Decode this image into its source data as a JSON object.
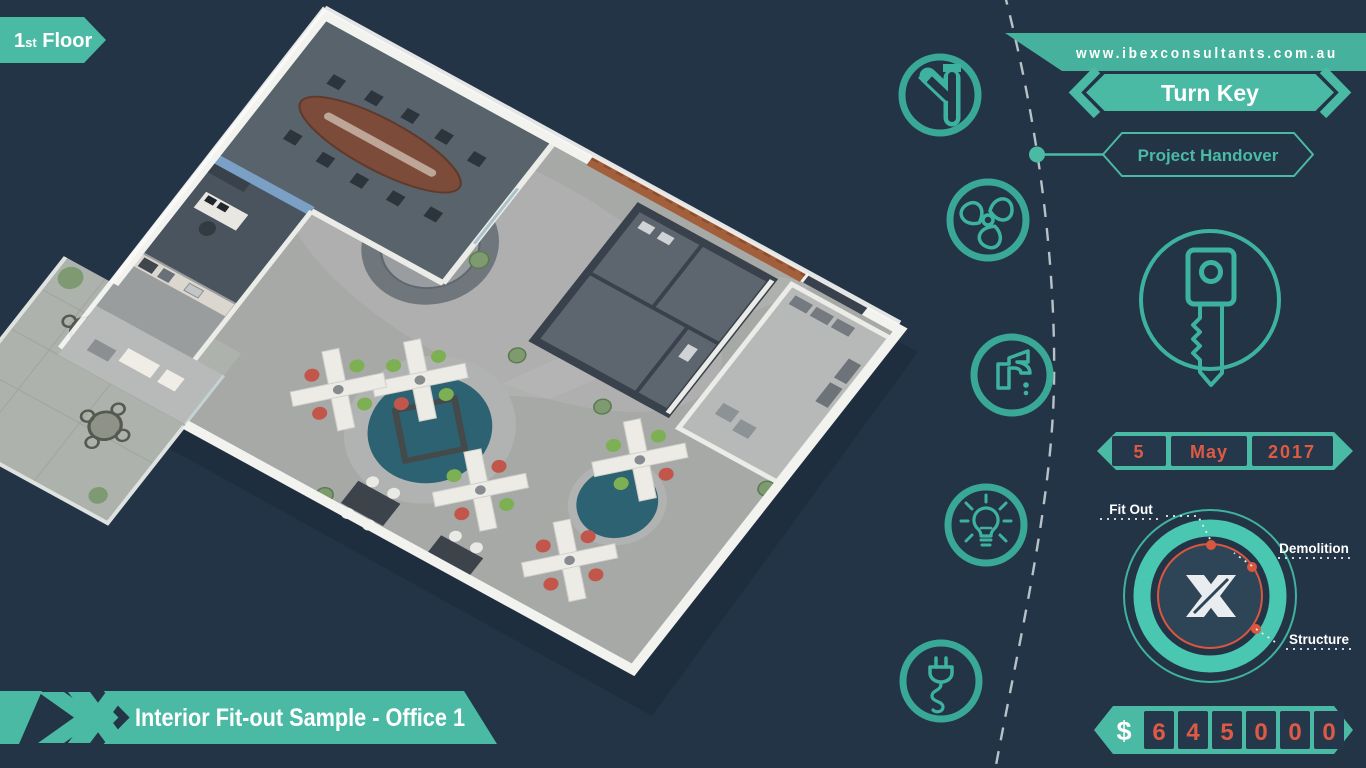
{
  "page": {
    "background": "#233447"
  },
  "colors": {
    "teal": "#4bbaa5",
    "teal_dark": "#3aa896",
    "teal_line": "#3db2a0",
    "orange": "#df5a44",
    "box_dark": "#25374a",
    "white": "#ffffff"
  },
  "floor_badge": {
    "number": "1",
    "suffix": "st",
    "word": "Floor"
  },
  "website": {
    "url": "www.ibexconsultants.com.au"
  },
  "milestone": {
    "title": "Turn Key",
    "subtitle": "Project Handover"
  },
  "service_icons": [
    "plumbing-pipe-icon",
    "hvac-fan-icon",
    "water-tap-icon",
    "lighting-bulb-icon",
    "electrical-plug-icon"
  ],
  "key_symbol": "turn-key-icon",
  "handover_date": {
    "day": "5",
    "month": "May",
    "year": "2017"
  },
  "scope_ring": {
    "logo": "X",
    "labels": [
      "Fit Out",
      "Demolition",
      "Structure"
    ]
  },
  "price": {
    "currency_symbol": "$",
    "digits": [
      "6",
      "4",
      "5",
      "0",
      "0",
      "0"
    ],
    "value": "645000"
  },
  "caption": {
    "title": "Interior Fit-out Sample - Office 1",
    "logo": "X"
  }
}
